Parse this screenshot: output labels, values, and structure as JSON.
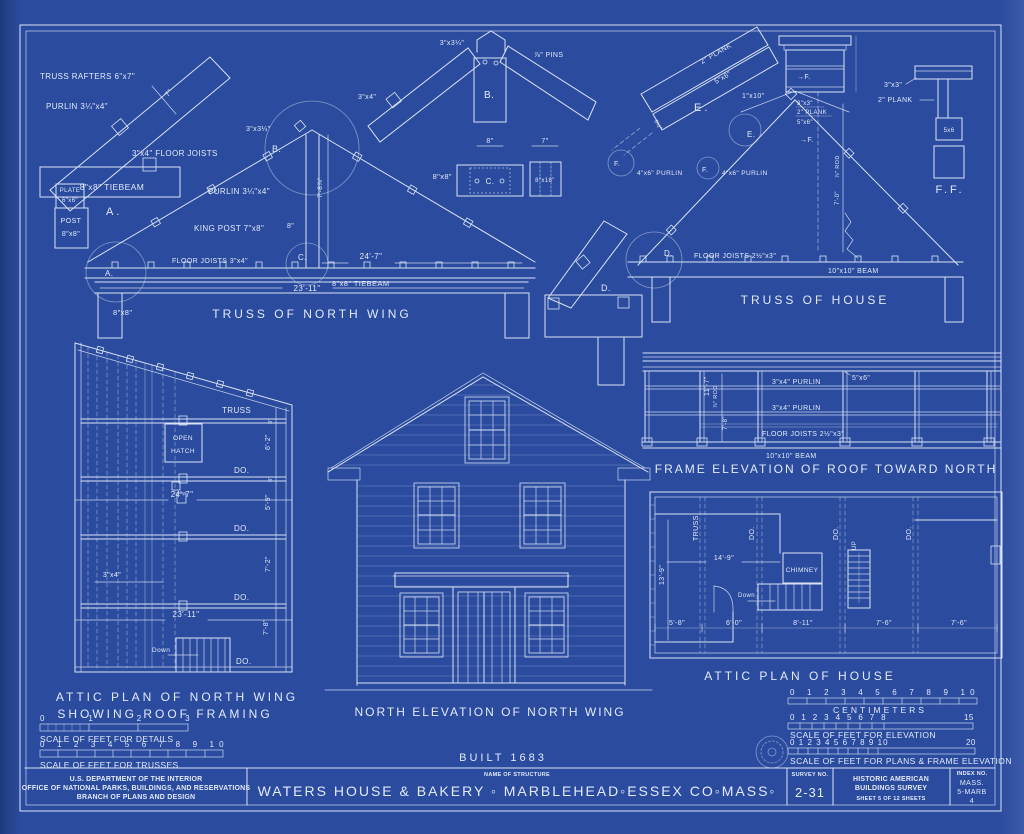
{
  "colors": {
    "background": "#2b4b9e",
    "line": "#d9e3f5",
    "text": "#e2eaf9"
  },
  "sheet": {
    "built": "BUILT 1683"
  },
  "truss_nw": {
    "caption": "TRUSS OF NORTH WING",
    "rafters": "TRUSS RAFTERS 6\"x7\"",
    "purlin_top": "PURLIN 3¼\"x4\"",
    "dim7": "7\"",
    "joists_top": "3\"x4\" FLOOR JOISTS",
    "tiebeam1": "8\"x8\" TIEBEAM",
    "plate1": "PLATE",
    "plate2": "6\"x6\"",
    "post1": "POST",
    "post2": "8\"x8\"",
    "label_a": "A.",
    "circle_a": "A.",
    "apex": "3\"x3¼\"",
    "circle_b": "B.",
    "purlin2": "PURLIN 3¼\"x4\"",
    "height": "7'-8⅞\"",
    "kingpost": "KING POST 7\"x8\"",
    "kingpost8": "8\"",
    "circle_c": "C.",
    "joists2": "FLOOR JOISTS 3\"x4\"",
    "dim247": "24'-7\"",
    "dim2311": "23'-11\"",
    "tiebeam2": "8\"x8\" TIEBEAM",
    "post_dim": "8\"x8\""
  },
  "detail_b": {
    "apex": "3\"x3¼\"",
    "pins": "⅞\" PINS",
    "rafter": "3\"x4\"",
    "label": "B.",
    "dim8": "8\"",
    "dim7": "7\"",
    "c_label": "C.",
    "c_dim": "8\"x8\"",
    "right_dim": "8\"x18\""
  },
  "truss_house": {
    "caption": "TRUSS OF HOUSE",
    "plank_e1": "2\" PLANK",
    "plank_e2": "5\"x6\"",
    "label_e": "E.",
    "dim_e": "6½\"",
    "circle_f1": "F.",
    "purlin_l": "4\"x6\" PURLIN",
    "circle_f2": "F.",
    "purlin_r": "4\"x6\" PURLIN",
    "circle_e": "E.",
    "board": "1\"x10\"",
    "apex1": "3\"x3\"",
    "apex2": "2\" PLANK",
    "apex3": "5\"x6\"",
    "f_ref_top": "→F.",
    "f_ref_bottom": "→F.",
    "rod": "⅞\" ROD",
    "rod_dim": "7'-0\"",
    "circle_d": "D.",
    "joists": "FLOOR JOISTS 2½\"x3\"",
    "beam": "10\"x10\" BEAM"
  },
  "detail_d": {
    "label": "D."
  },
  "detail_ff": {
    "size": "3\"x3\"",
    "plank": "2\" PLANK",
    "post": "5x6",
    "label": "F.F."
  },
  "attic_nw": {
    "caption1": "ATTIC PLAN OF NORTH WING",
    "caption2": "SHOWING ROOF FRAMING",
    "truss": "TRUSS",
    "do1": "DO.",
    "do2": "DO.",
    "do3": "DO.",
    "do4": "DO.",
    "open1": "OPEN",
    "open2": "HATCH",
    "dim247": "24'-7\"",
    "dim2311": "23'-11\"",
    "d62": "6'-2\"",
    "d59": "5'-9\"",
    "d72": "7'-2\"",
    "d78": "7'-8\"",
    "d8a": "8\"",
    "d8b": "8\"",
    "d34": "3\"x4\"",
    "down": "Down"
  },
  "north_elevation": {
    "caption": "NORTH ELEVATION OF NORTH WING"
  },
  "frame_elevation": {
    "caption": "FRAME ELEVATION OF ROOF TOWARD NORTH",
    "post": "5\"x6\"",
    "purlin1": "3\"x4\" PURLIN",
    "purlin2": "3\"x4\" PURLIN",
    "joists": "FLOOR JOISTS 2½\"x3\"",
    "beam": "10\"x10\" BEAM",
    "h1": "11'-7\"",
    "rod": "⅞\" ROD",
    "h2": "7'-8\""
  },
  "attic_house": {
    "caption": "ATTIC PLAN OF HOUSE",
    "truss": "TRUSS",
    "do1": "DO.",
    "do2": "DO.",
    "do3": "DO.",
    "chimney": "CHIMNEY",
    "down": "Down",
    "up": "UP",
    "d149": "14'-9\"",
    "d139": "13'-9\"",
    "d58": "5'-8\"",
    "d60": "6'-0\"",
    "d811": "8'-11\"",
    "d76a": "7'-6\"",
    "d76b": "7'-6\""
  },
  "scales_left": {
    "details_ticks": "0 1 2 3",
    "details_label": "SCALE OF FEET FOR DETAILS",
    "trusses_ticks": "0 1 2 3 4 5 6 7 8 9 10",
    "trusses_label": "SCALE OF FEET FOR TRUSSES"
  },
  "scales_right": {
    "cm_ticks": "0 1 2 3 4 5 6 7 8 9 10",
    "cm_label": "CENTIMETERS",
    "elev_ticks": "0 1 2 3 4 5 6 7 8",
    "elev_end": "15",
    "elev_label": "SCALE OF FEET FOR ELEVATION",
    "plans_ticks": "0 1 2 3 4 5 6 7 8 9 10",
    "plans_end": "20",
    "plans_label": "SCALE OF FEET FOR PLANS & FRAME ELEVATION"
  },
  "title_block": {
    "agency_line1": "U.S. DEPARTMENT OF THE INTERIOR",
    "agency_line2": "OFFICE OF NATIONAL PARKS, BUILDINGS, AND RESERVATIONS",
    "agency_line3": "BRANCH OF PLANS AND DESIGN",
    "name_of_structure_label": "NAME OF STRUCTURE",
    "structure_name": "WATERS HOUSE & BAKERY ◦ MARBLEHEAD◦ESSEX CO◦MASS◦",
    "survey_no_label": "SURVEY NO.",
    "survey_no": "2-31",
    "habs_line1": "HISTORIC AMERICAN",
    "habs_line2": "BUILDINGS SURVEY",
    "sheet_line": "SHEET 5 OF 12 SHEETS",
    "index_no_label": "INDEX NO.",
    "index_line1": "MASS.",
    "index_line2": "5-MARB",
    "index_line3": "4"
  }
}
